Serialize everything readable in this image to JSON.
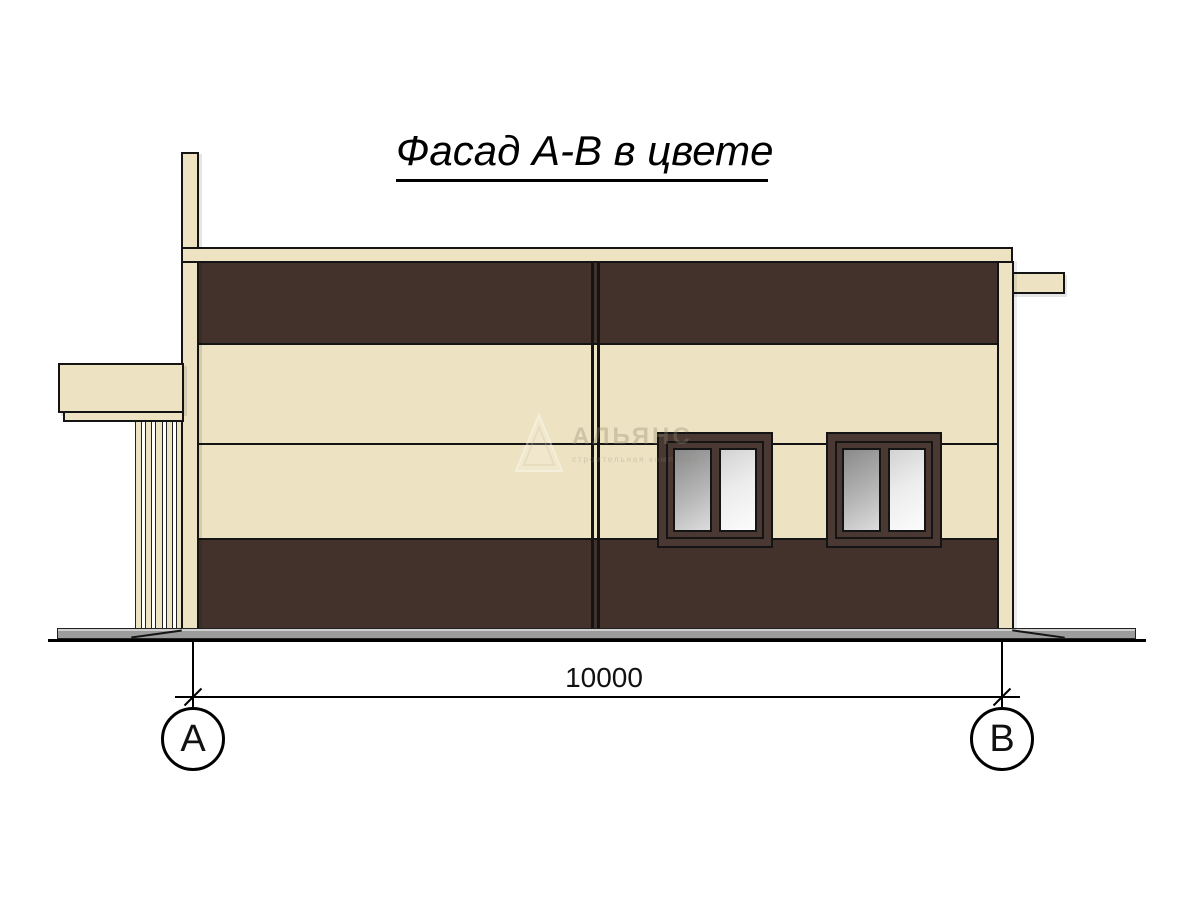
{
  "title": "Фасад А-В в цвете",
  "dimension": {
    "value": "10000"
  },
  "axes": {
    "left": "А",
    "right": "В"
  },
  "watermark": {
    "name": "АЛЬЯНС",
    "tagline": "строительная компания",
    "logo": "triangle-icon"
  },
  "colors": {
    "cream": "#EDE3C2",
    "brown": "#42322B",
    "frame": "#4A3833",
    "line": "#141414",
    "ground": "#9C9C9C",
    "glass-dark-start": "#8A8A8A",
    "glass-dark-end": "#DCDCDC",
    "glass-light-start": "#D2D2D2",
    "glass-light-end": "#FCFCFC"
  }
}
